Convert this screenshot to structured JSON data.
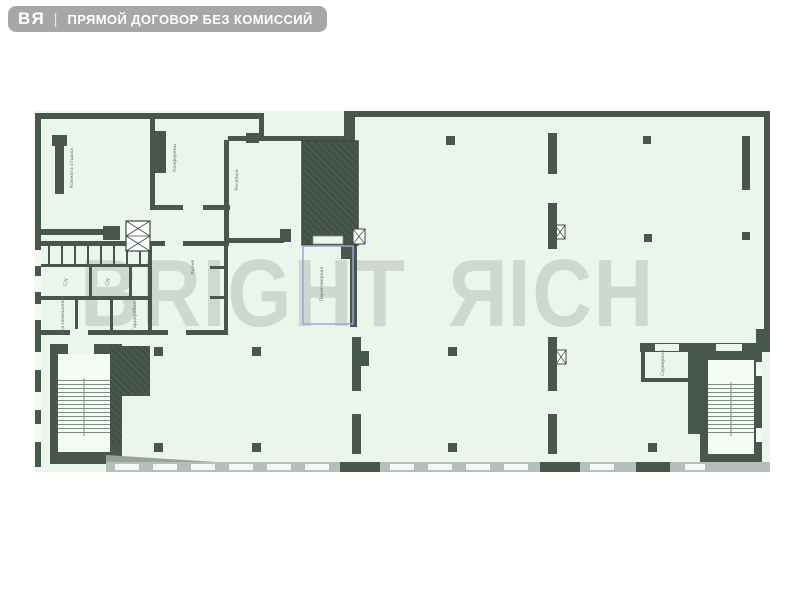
{
  "header": {
    "logo_b": "B",
    "logo_r": "R",
    "separator": "|",
    "tagline": "ПРЯМОЙ ДОГОВОР БЕЗ КОМИССИЙ"
  },
  "watermark": {
    "word1": "BRIGHT",
    "r": "R",
    "rest": "ICH"
  },
  "plan": {
    "rooms": {
      "lounge": {
        "label": "Комната отдыха"
      },
      "conference": {
        "label": "Конференц"
      },
      "reception": {
        "label": "Ресепшн"
      },
      "kitchen": {
        "label": "Кухня"
      },
      "meeting": {
        "label": "Переговорная"
      },
      "wc1": {
        "label": "С/у"
      },
      "wc2": {
        "label": "С/у"
      },
      "tech": {
        "label": "Тех.помещение"
      },
      "wardrobe": {
        "label": "Гардеробная"
      },
      "server": {
        "label": "Серверная"
      }
    },
    "colors": {
      "wall": "#47574b",
      "floor": "#ebf5ec",
      "blue_outline": "#98a6da",
      "watermark": "#c9d1c9",
      "window_band": "#b7bdb7",
      "badge": "#a7a7a7"
    }
  }
}
